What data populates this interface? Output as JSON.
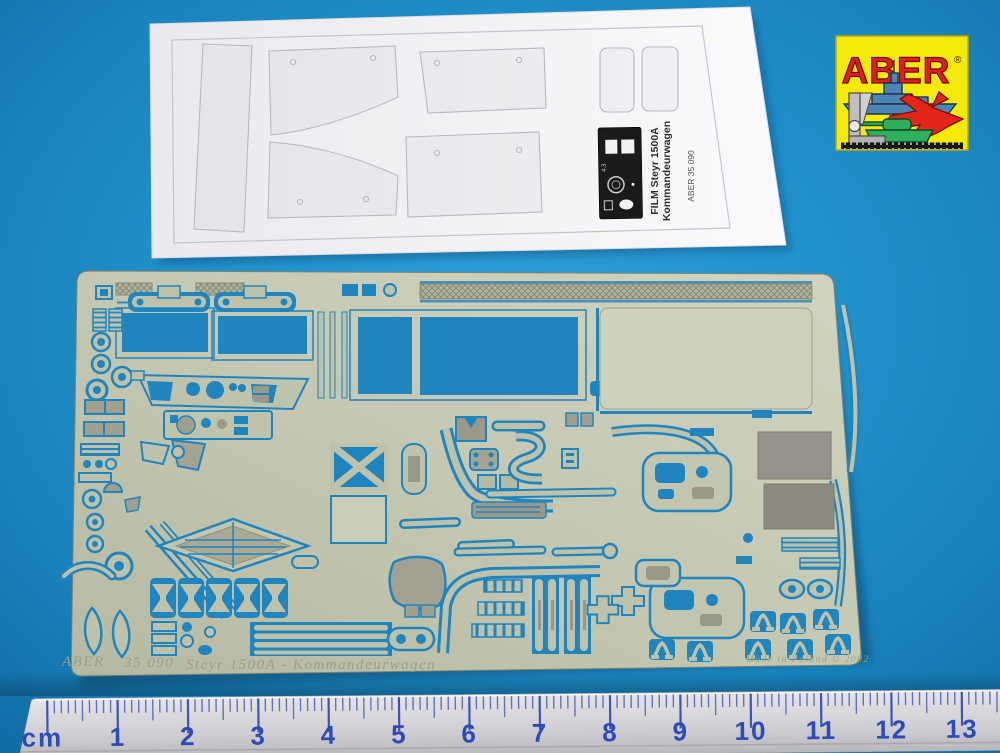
{
  "scene": {
    "description": "ABER photo-etched brass detail fret no. 35 090 for Steyr 1500A Kommandeurwagen, with clear printed film sheet, brand logo sticker and a centimetre ruler, photographed on a blue background"
  },
  "logo": {
    "brand": "ABER",
    "registered_mark": "®",
    "colors": {
      "background": "#F5E90A",
      "brand_text": "#E11D1D",
      "ship": "#4E83B5",
      "jet": "#E2261C",
      "tank": "#2FAE5E",
      "tool": "#BFBFBF"
    }
  },
  "film_sheet": {
    "label_line1": "FILM Steyr 1500A",
    "label_line2": "Kommandeurwagen",
    "catalog_code": "ABER 35 090",
    "panel_marking": "4.3"
  },
  "fret": {
    "etched_brand": "ABER",
    "etched_code": "35 090",
    "etched_name": "Steyr 1500A - Kommandeurwagen",
    "etched_origin": "Made in Poland © 2002",
    "brass_color": "#C6C9B3",
    "etch_show_through_color": "#1F85BF"
  },
  "ruler": {
    "unit_label": "cm",
    "numbers": [
      "1",
      "2",
      "3",
      "4",
      "5",
      "6",
      "7",
      "8",
      "9",
      "10",
      "11",
      "12",
      "13"
    ],
    "number_color": "#2E4CB6",
    "body_color": "#D9D9DC"
  },
  "background": {
    "color": "#1E8CC6"
  }
}
